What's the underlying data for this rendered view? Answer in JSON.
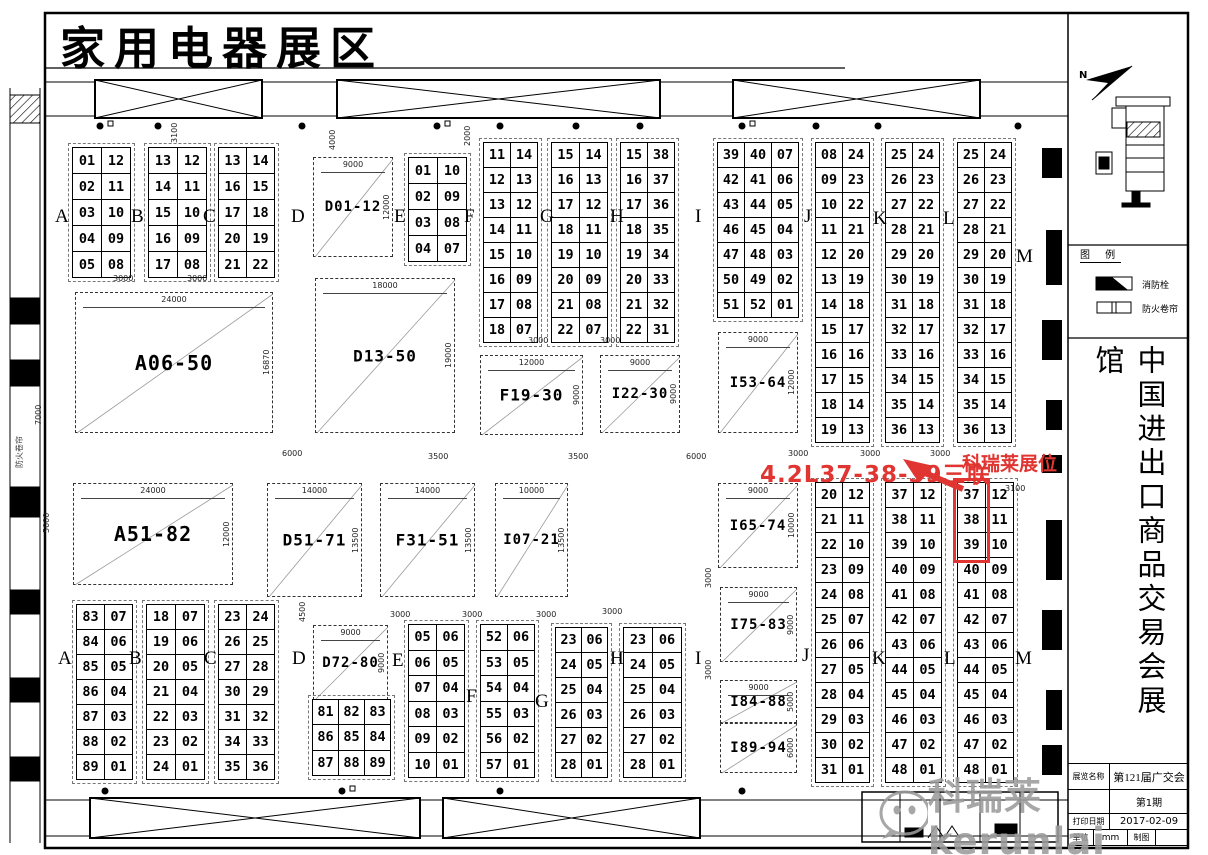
{
  "title": "家用电器展区",
  "colors": {
    "highlight": "#e03531",
    "watermark": "#9b9b9b"
  },
  "annotations": {
    "link_label": "4.2L37-38-39三联",
    "booth_label": "科瑞莱展位",
    "highlighted_booths": [
      "37",
      "38",
      "39"
    ]
  },
  "watermark": {
    "text": "科瑞莱kerunlai"
  },
  "side_panel": {
    "north_label": "N",
    "legend_title": "图 例",
    "legend_items": [
      "消防栓",
      "防火卷帘"
    ],
    "hall_name": "中国进出口商品交易会展馆",
    "title_block": {
      "name_label": "展览名称",
      "name_value": "第121届广交会",
      "issue_label": "",
      "issue_value": "第1期",
      "date_label": "打印日期",
      "date_value": "2017-02-09",
      "unit_label": "单位",
      "unit_value": "mm",
      "draw_label": "制图"
    }
  },
  "left_wall_label": "防火卷帘",
  "section_labels": [
    {
      "t": "A",
      "x": 55,
      "y": 206
    },
    {
      "t": "B",
      "x": 131,
      "y": 206
    },
    {
      "t": "C",
      "x": 203,
      "y": 206
    },
    {
      "t": "D",
      "x": 291,
      "y": 206
    },
    {
      "t": "E",
      "x": 394,
      "y": 206
    },
    {
      "t": "F",
      "x": 464,
      "y": 206
    },
    {
      "t": "G",
      "x": 540,
      "y": 206
    },
    {
      "t": "H",
      "x": 610,
      "y": 206
    },
    {
      "t": "I",
      "x": 695,
      "y": 206
    },
    {
      "t": "J",
      "x": 804,
      "y": 206
    },
    {
      "t": "K",
      "x": 873,
      "y": 208
    },
    {
      "t": "L",
      "x": 943,
      "y": 208
    },
    {
      "t": "M",
      "x": 1016,
      "y": 246
    },
    {
      "t": "A",
      "x": 58,
      "y": 648
    },
    {
      "t": "B",
      "x": 129,
      "y": 648
    },
    {
      "t": "C",
      "x": 204,
      "y": 648
    },
    {
      "t": "D",
      "x": 292,
      "y": 648
    },
    {
      "t": "E",
      "x": 392,
      "y": 650
    },
    {
      "t": "F",
      "x": 466,
      "y": 686
    },
    {
      "t": "G",
      "x": 535,
      "y": 691
    },
    {
      "t": "H",
      "x": 610,
      "y": 648
    },
    {
      "t": "I",
      "x": 695,
      "y": 648
    },
    {
      "t": "J",
      "x": 802,
      "y": 645
    },
    {
      "t": "K",
      "x": 872,
      "y": 648
    },
    {
      "t": "L",
      "x": 944,
      "y": 648
    },
    {
      "t": "M",
      "x": 1015,
      "y": 648
    }
  ],
  "blocks": [
    {
      "label": "D01-12",
      "x": 313,
      "y": 157,
      "w": 80,
      "h": 100,
      "dt": "9000",
      "dr": "12000"
    },
    {
      "label": "A06-50",
      "x": 75,
      "y": 292,
      "w": 198,
      "h": 141,
      "dt": "24000",
      "dr": "16870"
    },
    {
      "label": "D13-50",
      "x": 315,
      "y": 278,
      "w": 140,
      "h": 155,
      "dt": "18000",
      "dr": "19000"
    },
    {
      "label": "F19-30",
      "x": 480,
      "y": 355,
      "w": 103,
      "h": 80,
      "dt": "12000",
      "dr": "9000"
    },
    {
      "label": "I22-30",
      "x": 600,
      "y": 355,
      "w": 80,
      "h": 78,
      "dt": "9000",
      "dr": "9000"
    },
    {
      "label": "I53-64",
      "x": 718,
      "y": 332,
      "w": 80,
      "h": 101,
      "dt": "9000",
      "dr": "12000"
    },
    {
      "label": "A51-82",
      "x": 73,
      "y": 483,
      "w": 160,
      "h": 102,
      "dt": "24000",
      "dr": "12000"
    },
    {
      "label": "D51-71",
      "x": 267,
      "y": 483,
      "w": 95,
      "h": 114,
      "dt": "14000",
      "dr": "13500"
    },
    {
      "label": "F31-51",
      "x": 380,
      "y": 483,
      "w": 95,
      "h": 114,
      "dt": "14000",
      "dr": "13500"
    },
    {
      "label": "I07-21",
      "x": 495,
      "y": 483,
      "w": 73,
      "h": 114,
      "dt": "10000",
      "dr": "13500"
    },
    {
      "label": "I65-74",
      "x": 718,
      "y": 483,
      "w": 80,
      "h": 85,
      "dt": "9000",
      "dr": "10000"
    },
    {
      "label": "I75-83",
      "x": 720,
      "y": 587,
      "w": 77,
      "h": 75,
      "dt": "9000",
      "dr": "9000"
    },
    {
      "label": "I84-88",
      "x": 720,
      "y": 680,
      "w": 77,
      "h": 43,
      "dt": "9000",
      "dr": "5000"
    },
    {
      "label": "I89-94",
      "x": 720,
      "y": 723,
      "w": 77,
      "h": 50,
      "dt": "",
      "dr": "6000"
    },
    {
      "label": "D72-80",
      "x": 313,
      "y": 625,
      "w": 75,
      "h": 75,
      "dt": "9000",
      "dr": "9000"
    }
  ],
  "grids": [
    {
      "n": "top-A",
      "x": 73,
      "y": 148,
      "cw": 28,
      "rh": 25,
      "rows": [
        [
          "01",
          "12"
        ],
        [
          "02",
          "11"
        ],
        [
          "03",
          "10"
        ],
        [
          "04",
          "09"
        ],
        [
          "05",
          "08"
        ]
      ]
    },
    {
      "n": "top-B",
      "x": 149,
      "y": 148,
      "cw": 28,
      "rh": 25,
      "rows": [
        [
          "13",
          "12"
        ],
        [
          "14",
          "11"
        ],
        [
          "15",
          "10"
        ],
        [
          "16",
          "09"
        ],
        [
          "17",
          "08"
        ]
      ]
    },
    {
      "n": "top-C",
      "x": 219,
      "y": 148,
      "cw": 27,
      "rh": 25,
      "rows": [
        [
          "13",
          "14"
        ],
        [
          "16",
          "15"
        ],
        [
          "17",
          "18"
        ],
        [
          "20",
          "19"
        ],
        [
          "21",
          "22"
        ]
      ]
    },
    {
      "n": "top-EF",
      "x": 409,
      "y": 158,
      "cw": 28,
      "rh": 25,
      "rows": [
        [
          "01",
          "10"
        ],
        [
          "02",
          "09"
        ],
        [
          "03",
          "08"
        ],
        [
          "04",
          "07"
        ]
      ]
    },
    {
      "n": "top-FG",
      "x": 484,
      "y": 143,
      "cw": 26,
      "rh": 24,
      "rows": [
        [
          "11",
          "14"
        ],
        [
          "12",
          "13"
        ],
        [
          "13",
          "12"
        ],
        [
          "14",
          "11"
        ],
        [
          "15",
          "10"
        ],
        [
          "16",
          "09"
        ],
        [
          "17",
          "08"
        ],
        [
          "18",
          "07"
        ]
      ]
    },
    {
      "n": "top-GH",
      "x": 552,
      "y": 143,
      "cw": 27,
      "rh": 24,
      "rows": [
        [
          "15",
          "14"
        ],
        [
          "16",
          "13"
        ],
        [
          "17",
          "12"
        ],
        [
          "18",
          "11"
        ],
        [
          "19",
          "10"
        ],
        [
          "20",
          "09"
        ],
        [
          "21",
          "08"
        ],
        [
          "22",
          "07"
        ]
      ]
    },
    {
      "n": "top-HI",
      "x": 621,
      "y": 143,
      "cw": 26,
      "rh": 24,
      "rows": [
        [
          "15",
          "38"
        ],
        [
          "16",
          "37"
        ],
        [
          "17",
          "36"
        ],
        [
          "18",
          "35"
        ],
        [
          "19",
          "34"
        ],
        [
          "20",
          "33"
        ],
        [
          "21",
          "32"
        ],
        [
          "22",
          "31"
        ]
      ]
    },
    {
      "n": "top-I",
      "x": 718,
      "y": 143,
      "cw": 26,
      "rh": 24,
      "rows": [
        [
          "39",
          "40",
          "07"
        ],
        [
          "42",
          "41",
          "06"
        ],
        [
          "43",
          "44",
          "05"
        ],
        [
          "46",
          "45",
          "04"
        ],
        [
          "47",
          "48",
          "03"
        ],
        [
          "50",
          "49",
          "02"
        ],
        [
          "51",
          "52",
          "01"
        ]
      ]
    },
    {
      "n": "top-JK",
      "x": 816,
      "y": 143,
      "cw": 26,
      "rh": 24,
      "rows": [
        [
          "08",
          "24"
        ],
        [
          "09",
          "23"
        ],
        [
          "10",
          "22"
        ],
        [
          "11",
          "21"
        ],
        [
          "12",
          "20"
        ],
        [
          "13",
          "19"
        ],
        [
          "14",
          "18"
        ],
        [
          "15",
          "17"
        ],
        [
          "16",
          "16"
        ],
        [
          "17",
          "15"
        ],
        [
          "18",
          "14"
        ],
        [
          "19",
          "13"
        ]
      ]
    },
    {
      "n": "top-KL",
      "x": 886,
      "y": 143,
      "cw": 26,
      "rh": 24,
      "rows": [
        [
          "25",
          "24"
        ],
        [
          "26",
          "23"
        ],
        [
          "27",
          "22"
        ],
        [
          "28",
          "21"
        ],
        [
          "29",
          "20"
        ],
        [
          "30",
          "19"
        ],
        [
          "31",
          "18"
        ],
        [
          "32",
          "17"
        ],
        [
          "33",
          "16"
        ],
        [
          "34",
          "15"
        ],
        [
          "35",
          "14"
        ],
        [
          "36",
          "13"
        ]
      ]
    },
    {
      "n": "top-LM",
      "x": 958,
      "y": 143,
      "cw": 26,
      "rh": 24,
      "rows": [
        [
          "25",
          "24"
        ],
        [
          "26",
          "23"
        ],
        [
          "27",
          "22"
        ],
        [
          "28",
          "21"
        ],
        [
          "29",
          "20"
        ],
        [
          "30",
          "19"
        ],
        [
          "31",
          "18"
        ],
        [
          "32",
          "17"
        ],
        [
          "33",
          "16"
        ],
        [
          "34",
          "15"
        ],
        [
          "35",
          "14"
        ],
        [
          "36",
          "13"
        ]
      ]
    },
    {
      "n": "low-JK",
      "x": 816,
      "y": 483,
      "cw": 26,
      "rh": 24,
      "rows": [
        [
          "20",
          "12"
        ],
        [
          "21",
          "11"
        ],
        [
          "22",
          "10"
        ],
        [
          "23",
          "09"
        ],
        [
          "24",
          "08"
        ],
        [
          "25",
          "07"
        ],
        [
          "26",
          "06"
        ],
        [
          "27",
          "05"
        ],
        [
          "28",
          "04"
        ],
        [
          "29",
          "03"
        ],
        [
          "30",
          "02"
        ],
        [
          "31",
          "01"
        ]
      ]
    },
    {
      "n": "low-KL",
      "x": 886,
      "y": 483,
      "cw": 27,
      "rh": 24,
      "rows": [
        [
          "37",
          "12"
        ],
        [
          "38",
          "11"
        ],
        [
          "39",
          "10"
        ],
        [
          "40",
          "09"
        ],
        [
          "41",
          "08"
        ],
        [
          "42",
          "07"
        ],
        [
          "43",
          "06"
        ],
        [
          "44",
          "05"
        ],
        [
          "45",
          "04"
        ],
        [
          "46",
          "03"
        ],
        [
          "47",
          "02"
        ],
        [
          "48",
          "01"
        ]
      ]
    },
    {
      "n": "low-LM",
      "x": 958,
      "y": 483,
      "cw": 27,
      "rh": 24,
      "highlight": {
        "rows": 3,
        "col": 0
      },
      "rows": [
        [
          "37",
          "12"
        ],
        [
          "38",
          "11"
        ],
        [
          "39",
          "10"
        ],
        [
          "40",
          "09"
        ],
        [
          "41",
          "08"
        ],
        [
          "42",
          "07"
        ],
        [
          "43",
          "06"
        ],
        [
          "44",
          "05"
        ],
        [
          "45",
          "04"
        ],
        [
          "46",
          "03"
        ],
        [
          "47",
          "02"
        ],
        [
          "48",
          "01"
        ]
      ]
    },
    {
      "n": "low-A",
      "x": 77,
      "y": 605,
      "cw": 27,
      "rh": 24,
      "rows": [
        [
          "83",
          "07"
        ],
        [
          "84",
          "06"
        ],
        [
          "85",
          "05"
        ],
        [
          "86",
          "04"
        ],
        [
          "87",
          "03"
        ],
        [
          "88",
          "02"
        ],
        [
          "89",
          "01"
        ]
      ]
    },
    {
      "n": "low-B",
      "x": 147,
      "y": 605,
      "cw": 28,
      "rh": 24,
      "rows": [
        [
          "18",
          "07"
        ],
        [
          "19",
          "06"
        ],
        [
          "20",
          "05"
        ],
        [
          "21",
          "04"
        ],
        [
          "22",
          "03"
        ],
        [
          "23",
          "02"
        ],
        [
          "24",
          "01"
        ]
      ]
    },
    {
      "n": "low-C",
      "x": 219,
      "y": 605,
      "cw": 27,
      "rh": 24,
      "rows": [
        [
          "23",
          "24"
        ],
        [
          "26",
          "25"
        ],
        [
          "27",
          "28"
        ],
        [
          "30",
          "29"
        ],
        [
          "31",
          "32"
        ],
        [
          "34",
          "33"
        ],
        [
          "35",
          "36"
        ]
      ]
    },
    {
      "n": "low-EF",
      "x": 409,
      "y": 625,
      "cw": 27,
      "rh": 24.5,
      "rows": [
        [
          "05",
          "06"
        ],
        [
          "06",
          "05"
        ],
        [
          "07",
          "04"
        ],
        [
          "08",
          "03"
        ],
        [
          "09",
          "02"
        ],
        [
          "10",
          "01"
        ]
      ]
    },
    {
      "n": "low-FG",
      "x": 481,
      "y": 625,
      "cw": 26,
      "rh": 24.5,
      "rows": [
        [
          "52",
          "06"
        ],
        [
          "53",
          "05"
        ],
        [
          "54",
          "04"
        ],
        [
          "55",
          "03"
        ],
        [
          "56",
          "02"
        ],
        [
          "57",
          "01"
        ]
      ]
    },
    {
      "n": "low-GH",
      "x": 556,
      "y": 628,
      "cw": 25,
      "rh": 24,
      "rows": [
        [
          "23",
          "06"
        ],
        [
          "24",
          "05"
        ],
        [
          "25",
          "04"
        ],
        [
          "26",
          "03"
        ],
        [
          "27",
          "02"
        ],
        [
          "28",
          "01"
        ]
      ]
    },
    {
      "n": "low-HI",
      "x": 624,
      "y": 628,
      "cw": 28,
      "rh": 24,
      "rows": [
        [
          "23",
          "06"
        ],
        [
          "24",
          "05"
        ],
        [
          "25",
          "04"
        ],
        [
          "26",
          "03"
        ],
        [
          "27",
          "02"
        ],
        [
          "28",
          "01"
        ]
      ]
    },
    {
      "n": "low-D72",
      "x": 313,
      "y": 700,
      "cw": 25,
      "rh": 24.3,
      "rows": [
        [
          "81",
          "82",
          "83"
        ],
        [
          "86",
          "85",
          "84"
        ],
        [
          "87",
          "88",
          "89"
        ]
      ]
    }
  ],
  "dims": [
    {
      "t": "3000",
      "x": 113,
      "y": 274,
      "v": 0
    },
    {
      "t": "3000",
      "x": 187,
      "y": 274,
      "v": 0
    },
    {
      "t": "3100",
      "x": 170,
      "y": 143,
      "v": 1
    },
    {
      "t": "4000",
      "x": 328,
      "y": 150,
      "v": 1
    },
    {
      "t": "2000",
      "x": 463,
      "y": 146,
      "v": 1
    },
    {
      "t": "3000",
      "x": 528,
      "y": 336,
      "v": 0
    },
    {
      "t": "3000",
      "x": 600,
      "y": 336,
      "v": 0
    },
    {
      "t": "7000",
      "x": 34,
      "y": 425,
      "v": 1
    },
    {
      "t": "5000",
      "x": 42,
      "y": 533,
      "v": 1
    },
    {
      "t": "6000",
      "x": 282,
      "y": 449,
      "v": 0
    },
    {
      "t": "3500",
      "x": 428,
      "y": 452,
      "v": 0
    },
    {
      "t": "3500",
      "x": 568,
      "y": 452,
      "v": 0
    },
    {
      "t": "6000",
      "x": 686,
      "y": 452,
      "v": 0
    },
    {
      "t": "3000",
      "x": 788,
      "y": 449,
      "v": 0
    },
    {
      "t": "3000",
      "x": 860,
      "y": 449,
      "v": 0
    },
    {
      "t": "3000",
      "x": 930,
      "y": 449,
      "v": 0
    },
    {
      "t": "3100",
      "x": 1005,
      "y": 484,
      "v": 0
    },
    {
      "t": "4500",
      "x": 298,
      "y": 622,
      "v": 1
    },
    {
      "t": "3000",
      "x": 390,
      "y": 610,
      "v": 0
    },
    {
      "t": "3000",
      "x": 462,
      "y": 610,
      "v": 0
    },
    {
      "t": "3000",
      "x": 536,
      "y": 610,
      "v": 0
    },
    {
      "t": "3000",
      "x": 602,
      "y": 607,
      "v": 0
    },
    {
      "t": "3000",
      "x": 704,
      "y": 588,
      "v": 1
    },
    {
      "t": "3000",
      "x": 704,
      "y": 680,
      "v": 1
    }
  ]
}
